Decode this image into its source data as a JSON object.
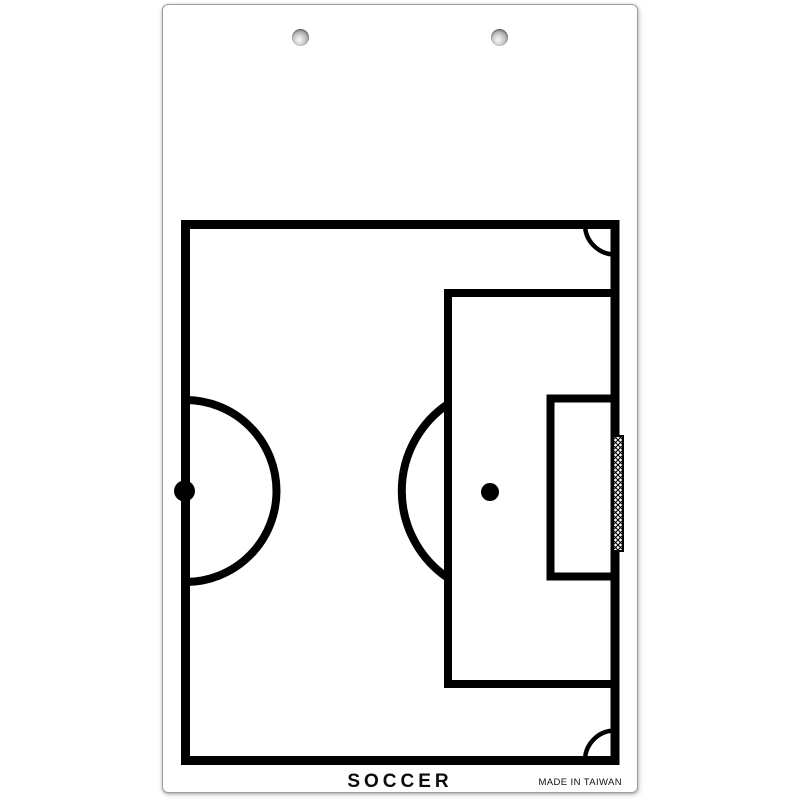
{
  "board": {
    "title": "SOCCER",
    "origin_label": "MADE IN TAIWAN",
    "type": "dry-erase soccer coaching board",
    "holes_count": 2,
    "colors": {
      "board_background": "#ffffff",
      "field_lines": "#000000",
      "board_edge": "#9e9e9e",
      "hole_shade": "#5e5e5e",
      "title_text": "#0a0a0a"
    },
    "field_diagram": {
      "view": "half-field, goal on right side",
      "elements": [
        "field-boundary",
        "halfway-line",
        "center-mark",
        "center-circle-half",
        "penalty-area",
        "goal-area",
        "penalty-spot",
        "penalty-arc",
        "corner-arc-top-right",
        "corner-arc-bottom-right",
        "goal-with-net"
      ]
    }
  }
}
